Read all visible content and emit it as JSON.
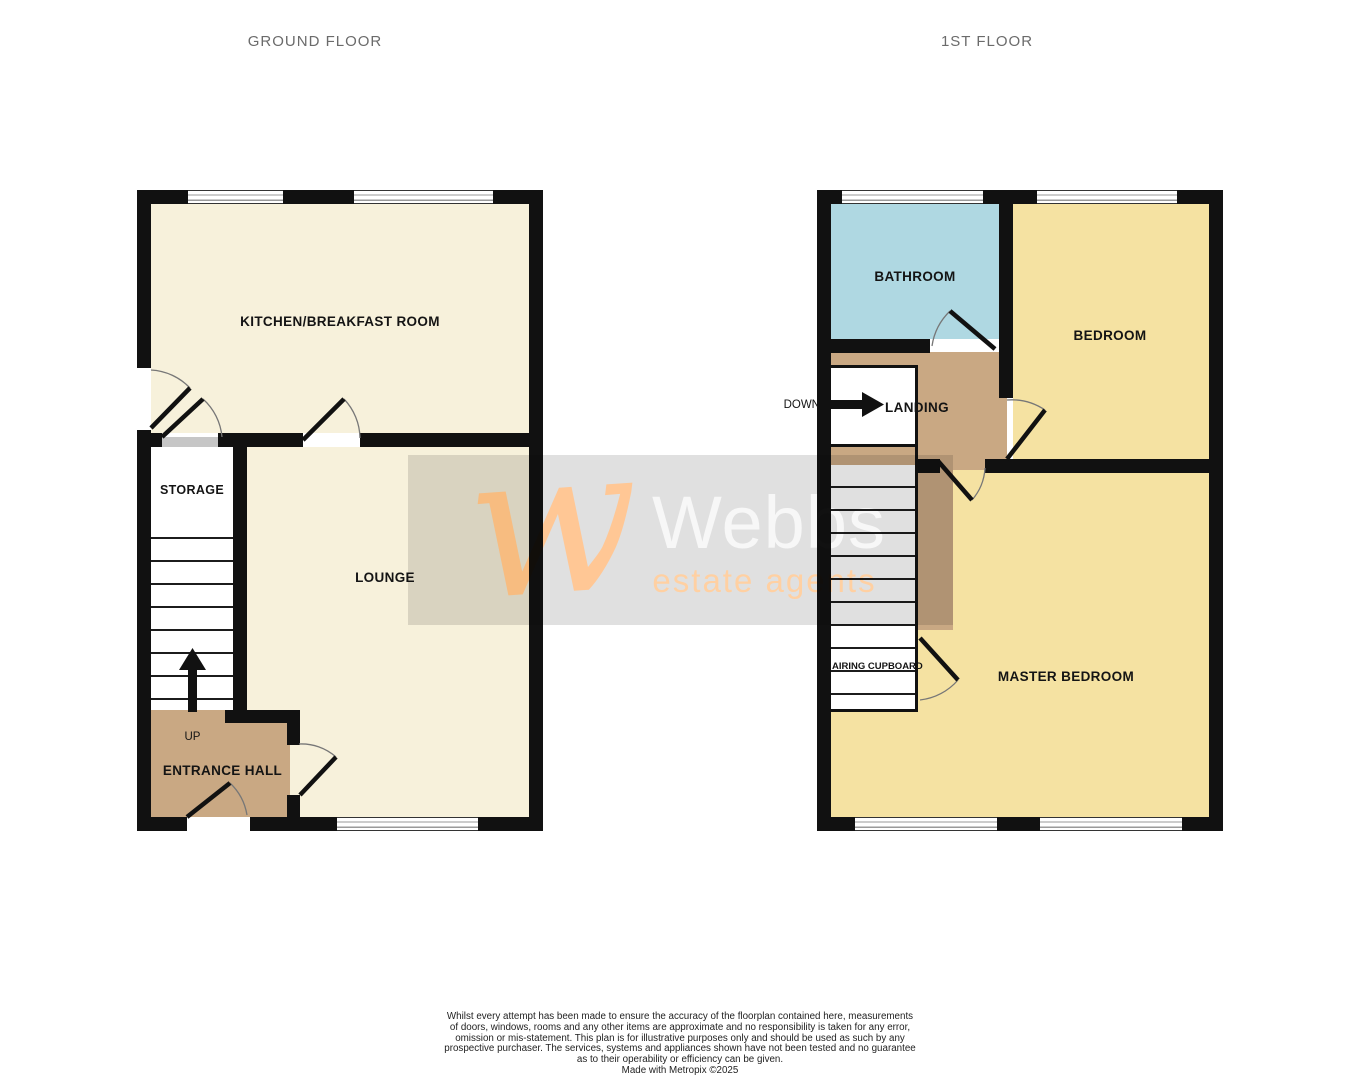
{
  "titles": {
    "ground": "GROUND FLOOR",
    "first": "1ST FLOOR"
  },
  "ground": {
    "kitchen": "KITCHEN/BREAKFAST ROOM",
    "storage": "STORAGE",
    "lounge": "LOUNGE",
    "entrance": "ENTRANCE HALL",
    "up": "UP"
  },
  "first": {
    "bathroom": "BATHROOM",
    "bedroom": "BEDROOM",
    "landing": "LANDING",
    "master": "MASTER BEDROOM",
    "airing": "AIRING CUPBOARD",
    "down": "DOWN"
  },
  "watermark": {
    "monogram": "w",
    "brand": "Webbs",
    "tagline": "estate agents"
  },
  "colors": {
    "room_cream": "#F7F1DB",
    "room_yellow": "#F5E2A2",
    "room_blue": "#AFD8E2",
    "hall_tan": "#C9A883",
    "wall_black": "#111111",
    "watermark_band": "#E0E0E0",
    "brand_orange": "#FFC795",
    "title_gray": "#6B6B6B"
  },
  "footer": {
    "lines": [
      "Whilst every attempt has been made to ensure the accuracy of the floorplan contained here, measurements",
      "of doors, windows, rooms and any other items are approximate and no responsibility is taken for any error,",
      "omission or mis-statement. This plan is for illustrative purposes only and should be used as such by any",
      "prospective purchaser. The services, systems and appliances shown have not been tested and no guarantee",
      "as to their operability or efficiency can be given."
    ],
    "credit": "Made with Metropix ©2025"
  }
}
